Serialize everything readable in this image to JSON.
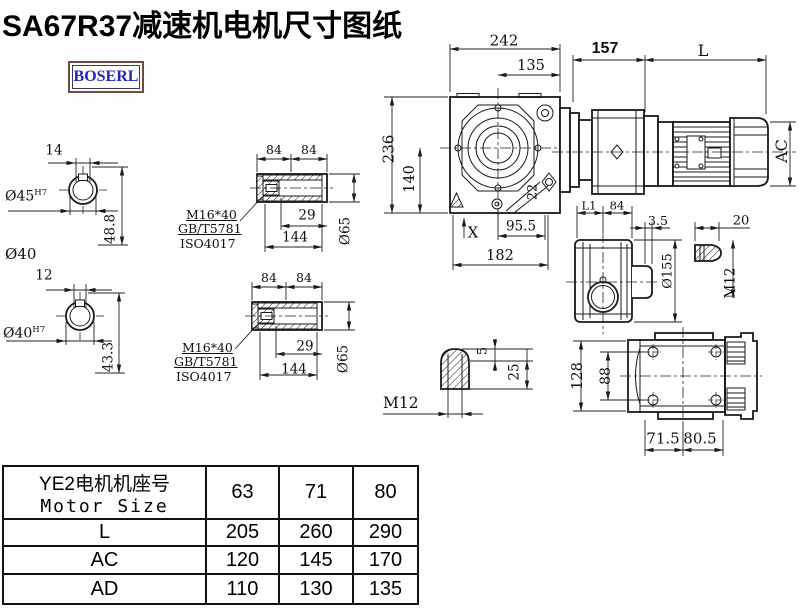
{
  "title": "SA67R37减速机电机尺寸图纸",
  "logo": {
    "text": "BOSERL",
    "text_color": "#2424c0",
    "border_color": "#6d4a42"
  },
  "colors": {
    "line": "#1a1a1a",
    "background": "#fefefe"
  },
  "dims": {
    "shaft_a": {
      "key_width": "14",
      "bore": "Ø45",
      "bore_fit": "H7",
      "height": "48.8",
      "shaft_dia": "Ø40"
    },
    "shaft_b": {
      "key_width": "12",
      "bore": "Ø40",
      "bore_fit": "H7",
      "height": "43.3"
    },
    "hollow_a": {
      "seg1": "84",
      "seg2": "84",
      "screw": "M16*40",
      "std1": "GB/T5781",
      "std2": "ISO4017",
      "depth": "29",
      "length": "144",
      "dia": "Ø65"
    },
    "hollow_b": {
      "seg1": "84",
      "seg2": "84",
      "screw": "M16*40",
      "std1": "GB/T5781",
      "std2": "ISO4017",
      "depth": "29",
      "length": "144",
      "dia": "Ø65"
    },
    "front": {
      "width": "242",
      "center_right": "135",
      "height": "236",
      "center_bottom": "140",
      "rib": "22",
      "foot_right": "95.5",
      "foot_width": "182",
      "x_mark": "X"
    },
    "motor": {
      "adapter_len": "157",
      "motor_len": "L",
      "motor_dia": "AC"
    },
    "flange": {
      "l1": "L1",
      "seg": "84",
      "lip": "3.5",
      "cap_len": "20",
      "dia": "Ø155",
      "thread": "M12"
    },
    "bottom": {
      "height": "128",
      "inner": "88",
      "left": "71.5",
      "right": "80.5"
    },
    "plug": {
      "tip": "5",
      "thread_len": "25",
      "thread": "M12"
    }
  },
  "table": {
    "header_cn": "YE2电机机座号",
    "header_en": "Motor Size",
    "columns": [
      "63",
      "71",
      "80"
    ],
    "rows": [
      {
        "label": "L",
        "values": [
          "205",
          "260",
          "290"
        ]
      },
      {
        "label": "AC",
        "values": [
          "120",
          "145",
          "170"
        ]
      },
      {
        "label": "AD",
        "values": [
          "110",
          "130",
          "135"
        ]
      }
    ]
  }
}
